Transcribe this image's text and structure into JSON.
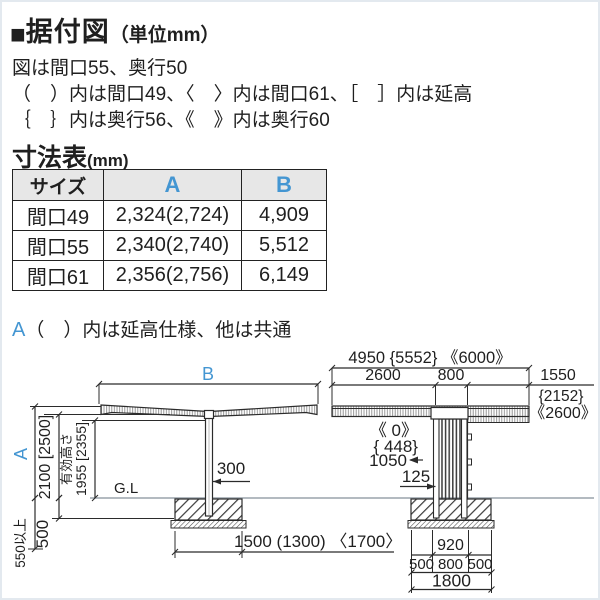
{
  "title": {
    "square": "■",
    "heading": "据付図",
    "unit": "（単位mm）"
  },
  "notes": {
    "line1": "図は間口55、奥行50",
    "line2": "（　）内は間口49、〈　〉内は間口61、［　］内は延高",
    "line3": "｛　｝内は奥行56、《　》内は奥行60"
  },
  "table": {
    "heading": "寸法表",
    "unit": "(mm)",
    "columns": [
      "サイズ",
      "A",
      "B"
    ],
    "rows": [
      [
        "間口49",
        "2,324(2,724)",
        "4,909"
      ],
      [
        "間口55",
        "2,340(2,740)",
        "5,512"
      ],
      [
        "間口61",
        "2,356(2,756)",
        "6,149"
      ]
    ],
    "footnote_prefix": "A",
    "footnote": "（　）内は延高仕様、他は共通"
  },
  "front_view": {
    "dim_b": "B",
    "dim_a": "A",
    "height_main": "2100 [2500]",
    "eff_label": "有効高さ",
    "eff_value": "1955 [2355]",
    "ground": "G.L",
    "post_width": "300",
    "found_depth": "500",
    "embed_min": "550以上",
    "found_width": "1500 (1300) 〈1700〉"
  },
  "side_view": {
    "total": "4950 {5552} 《6000》",
    "seg_front": "2600",
    "seg_post": "800",
    "seg_rear": "1550",
    "seg_rear_alt1": "{2152}",
    "seg_rear_alt2": "《2600》",
    "offset_alt2": "《  0》",
    "offset_alt1": "{ 448}",
    "offset": "1050",
    "inset": "125",
    "bolt_span": "920",
    "found_seg1": "500",
    "found_seg2": "800",
    "found_seg3": "500",
    "found_total": "1800"
  },
  "colors": {
    "accent_blue": "#4496d2",
    "line": "#2b2b2b",
    "ground_line": "#9aa3ab",
    "header_bg": "#e7e7e7"
  }
}
